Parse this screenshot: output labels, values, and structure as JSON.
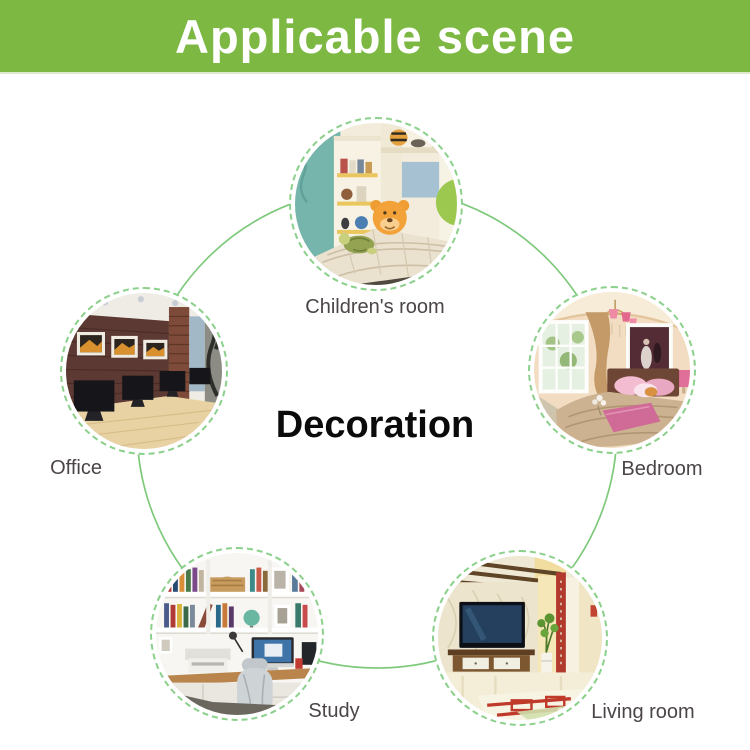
{
  "header": {
    "title": "Applicable scene"
  },
  "center_label": "Decoration",
  "scenes": [
    {
      "id": "children-room",
      "label": "Children's room"
    },
    {
      "id": "office",
      "label": "Office"
    },
    {
      "id": "bedroom",
      "label": "Bedroom"
    },
    {
      "id": "study",
      "label": "Study"
    },
    {
      "id": "living-room",
      "label": "Living room"
    }
  ],
  "colors": {
    "banner_green": "#7db843",
    "connector_green": "#7ec97b",
    "dashed_ring_green": "#8bd08b",
    "label_gray": "#4b4547",
    "center_text": "#0b0b0b"
  }
}
